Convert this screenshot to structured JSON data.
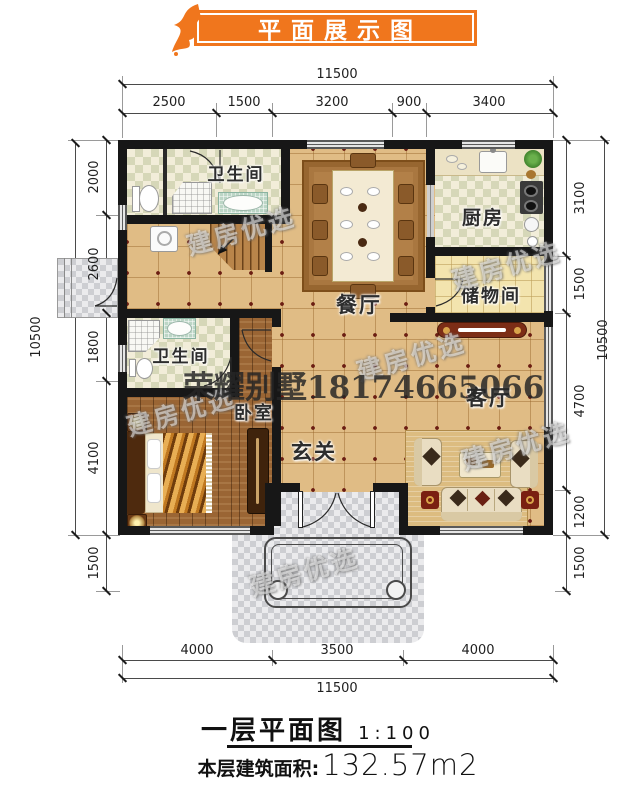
{
  "banner": {
    "title": "平面展示图",
    "color": "#f0761d"
  },
  "dimensions": {
    "top": {
      "overall": "11500",
      "segments": [
        "2500",
        "1500",
        "3200",
        "900",
        "3400"
      ]
    },
    "bottom": {
      "overall": "11500",
      "segments": [
        "4000",
        "3500",
        "4000"
      ]
    },
    "left": {
      "overall": "10500",
      "segments": [
        "2000",
        "2600",
        "1800",
        "4100",
        "1500"
      ]
    },
    "right": {
      "overall": "10500",
      "segments": [
        "3100",
        "1500",
        "4700",
        "1200",
        "1500"
      ]
    }
  },
  "rooms": {
    "bathroom_top": "卫生间",
    "bathroom_mid": "卫生间",
    "kitchen": "厨房",
    "dining": "餐厅",
    "storage": "储物间",
    "living": "客厅",
    "hall": "玄关",
    "bedroom": "卧室"
  },
  "watermarks": {
    "phone": "荣耀别墅18174665066",
    "brand": "建房优选"
  },
  "footer": {
    "plan_title": "一层平面图",
    "scale": "1:100",
    "area_label": "本层建筑面积:",
    "area_value": "132.57m2"
  },
  "colors": {
    "banner": "#f0761d",
    "wall": "#171717",
    "floor_tan": "#e0bc85",
    "floor_wood": "#9a6534",
    "floor_checker": "#d6d7b8",
    "porch_gray": "#cdced2",
    "tile_dot": "#6b1d12"
  }
}
